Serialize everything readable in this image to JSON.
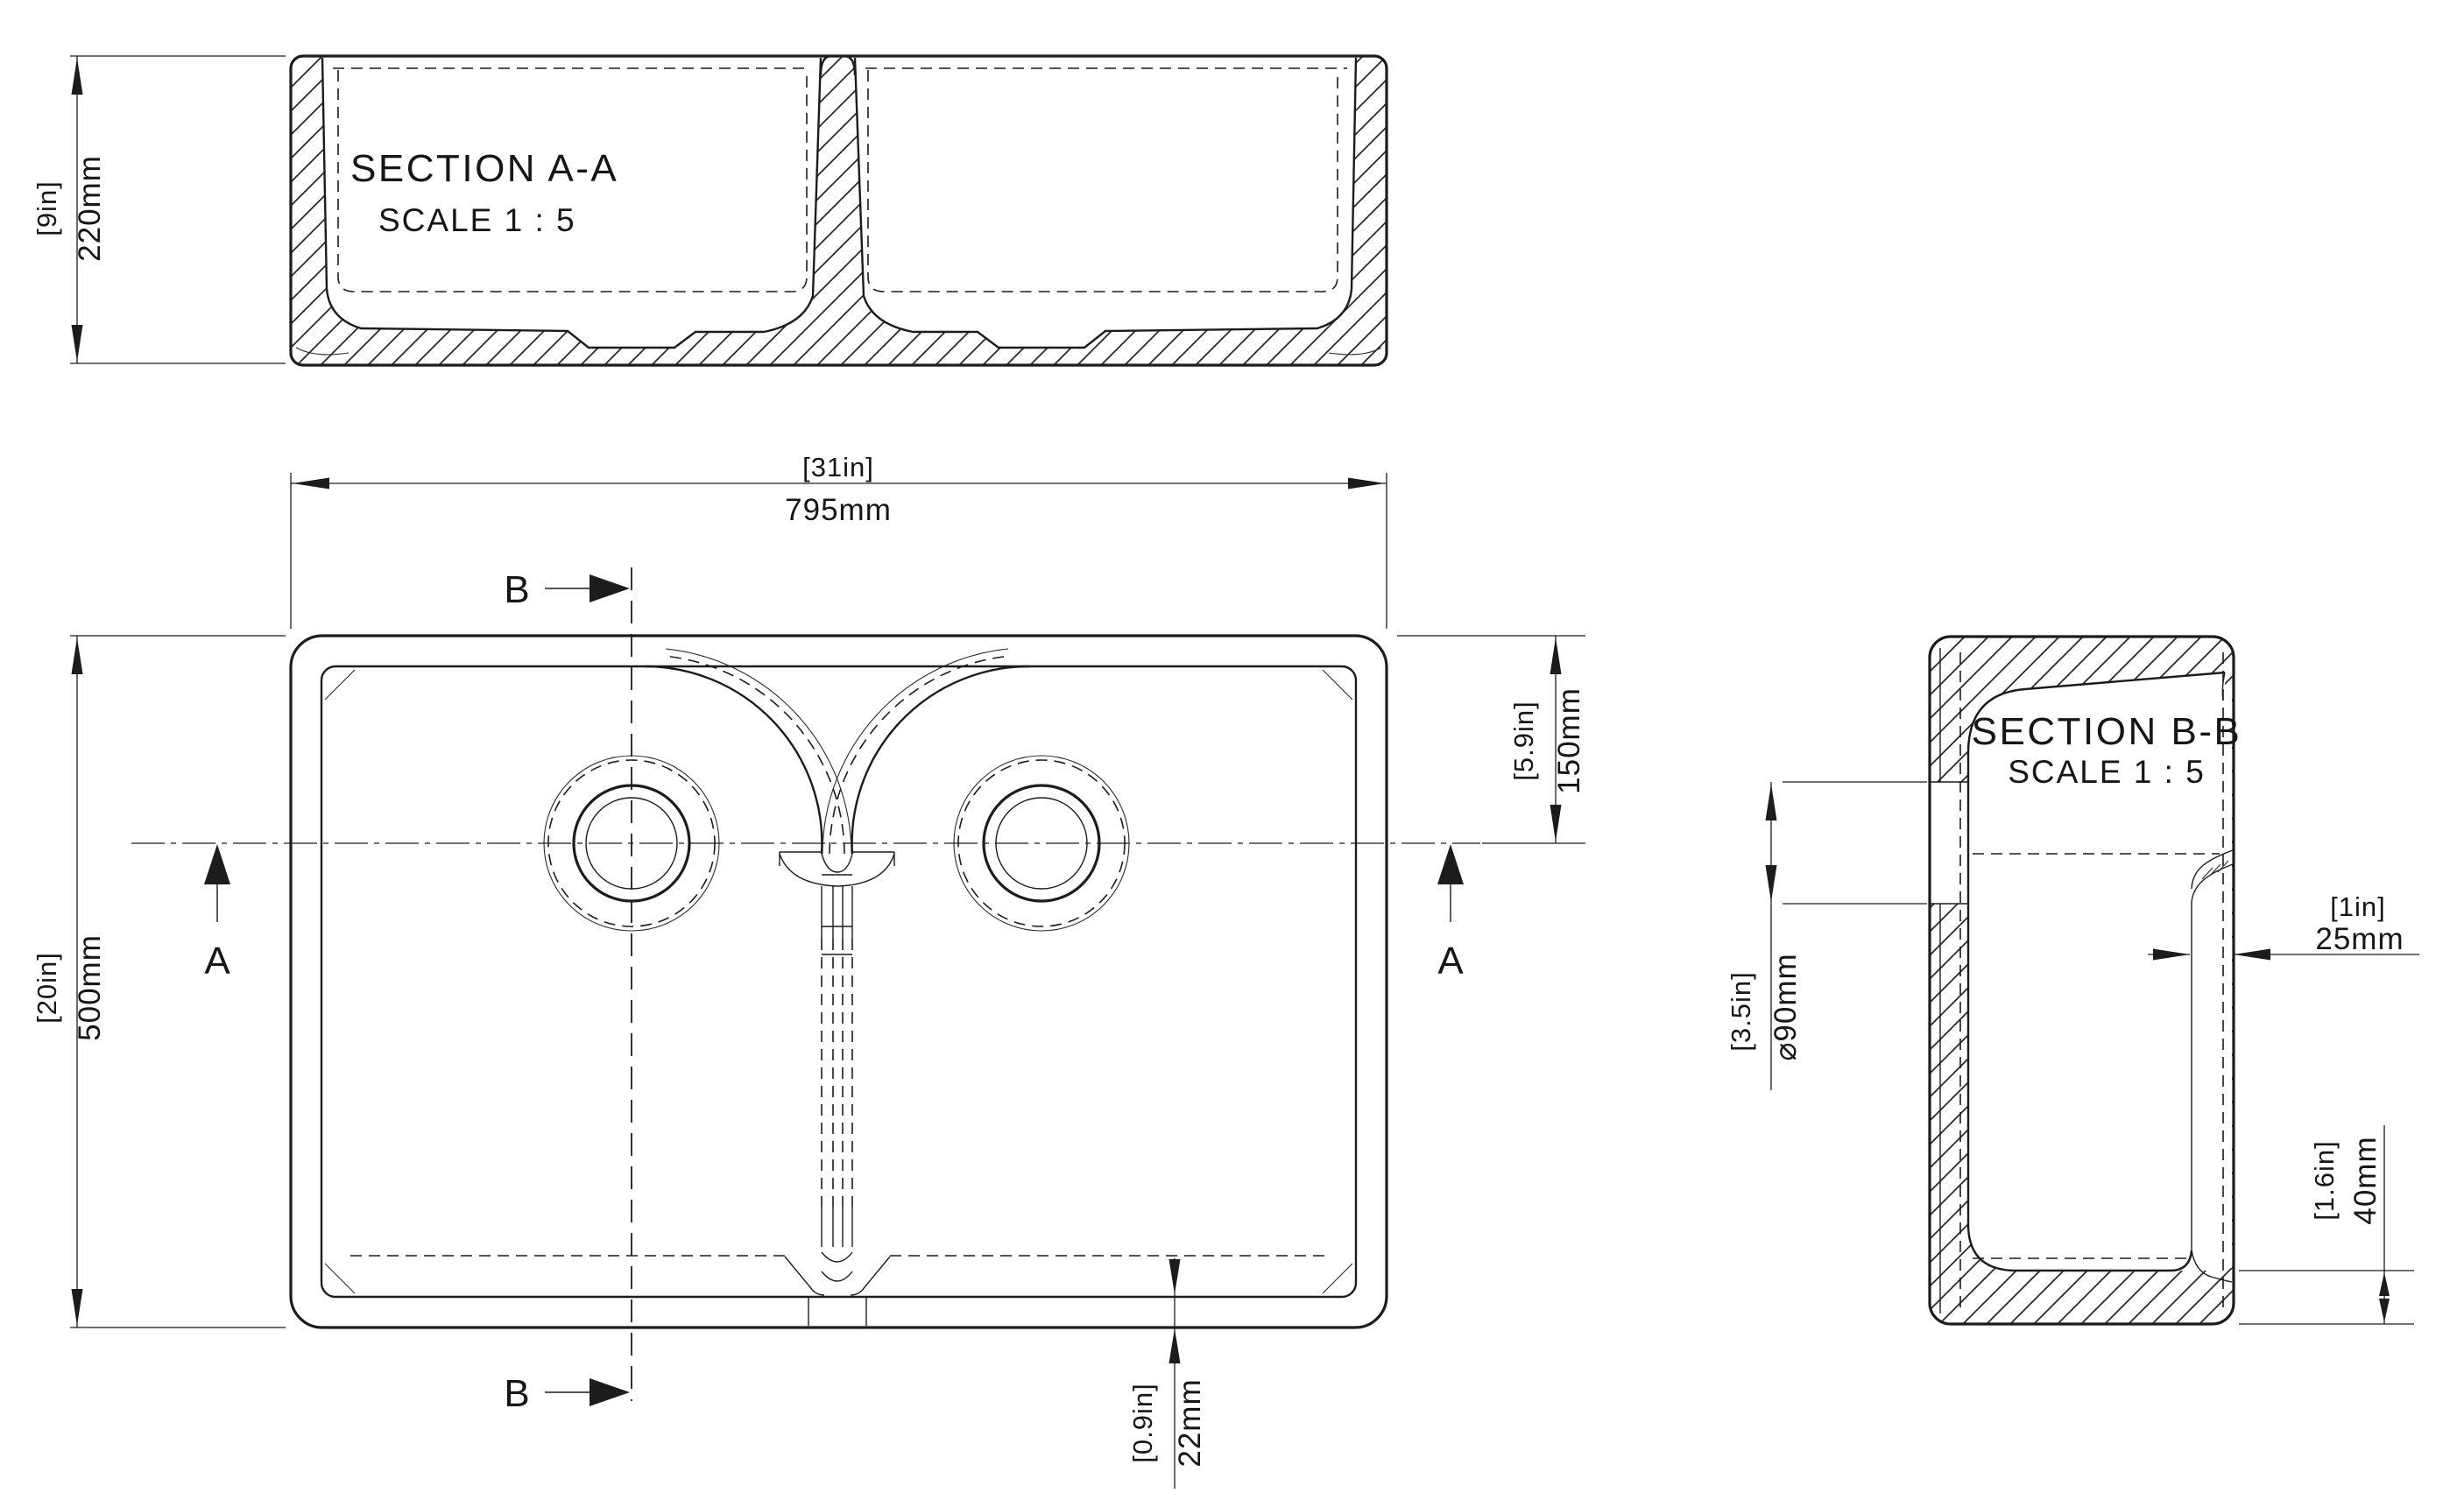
{
  "page": {
    "background": "#ffffff",
    "line_color": "#1c1c1c"
  },
  "views": {
    "section_aa": {
      "title": "SECTION A-A",
      "scale_note": "SCALE 1 : 5"
    },
    "section_bb": {
      "title": "SECTION B-B",
      "scale_note": "SCALE 1 : 5"
    },
    "plan": {
      "section_marker_a": "A",
      "section_marker_b": "B"
    }
  },
  "dimensions": {
    "overall_height": {
      "imperial": "[9in]",
      "metric": "220mm"
    },
    "overall_width": {
      "imperial": "[31in]",
      "metric": "795mm"
    },
    "overall_depth": {
      "imperial": "[20in]",
      "metric": "500mm"
    },
    "drain_center_offset": {
      "imperial": "[5.9in]",
      "metric": "150mm"
    },
    "wall_thickness": {
      "imperial": "[1in]",
      "metric": "25mm"
    },
    "drain_diameter": {
      "imperial": "[3.5in]",
      "metric": "⌀90mm"
    },
    "base_thickness": {
      "imperial": "[1.6in]",
      "metric": "40mm"
    },
    "rim_width": {
      "imperial": "[0.9in]",
      "metric": "22mm"
    }
  }
}
